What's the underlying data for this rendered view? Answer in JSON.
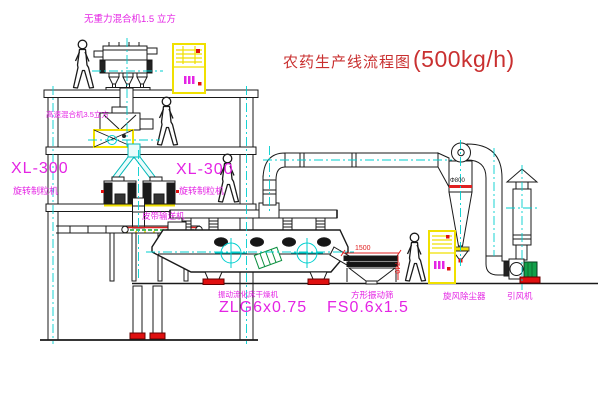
{
  "title": {
    "name": "农药生产线流程图",
    "capacity": "(500kg/h)"
  },
  "labels": {
    "mixer_top": "无重力混合机1.5 立方",
    "mixer_second": "高速混合机3.5立方",
    "granulator_left_model": "XL-300",
    "granulator_left_name": "旋转制粒机",
    "granulator_right_model": "XL-300",
    "granulator_right_name": "旋转制粒机",
    "belt_conveyor": "皮带输送机",
    "dryer_name": "振动流化床干燥机",
    "dryer_model": "ZLG6x0.75",
    "sieve_name": "方形振动筛",
    "sieve_model": "FS0.6x1.5",
    "cyclone_name": "旋风除尘器",
    "fan_name": "引风机"
  },
  "dimensions": {
    "sieve_length": "1500",
    "sieve_height": "740",
    "cyclone_diameter": "Φ800"
  },
  "colors": {
    "label_magenta": "#e424e4",
    "title_red": "#c93030",
    "centerline_cyan": "#00cfcf",
    "cabinet_yellow": "#f0e000",
    "motor_green": "#12a04a",
    "alert_red": "#e01010"
  }
}
